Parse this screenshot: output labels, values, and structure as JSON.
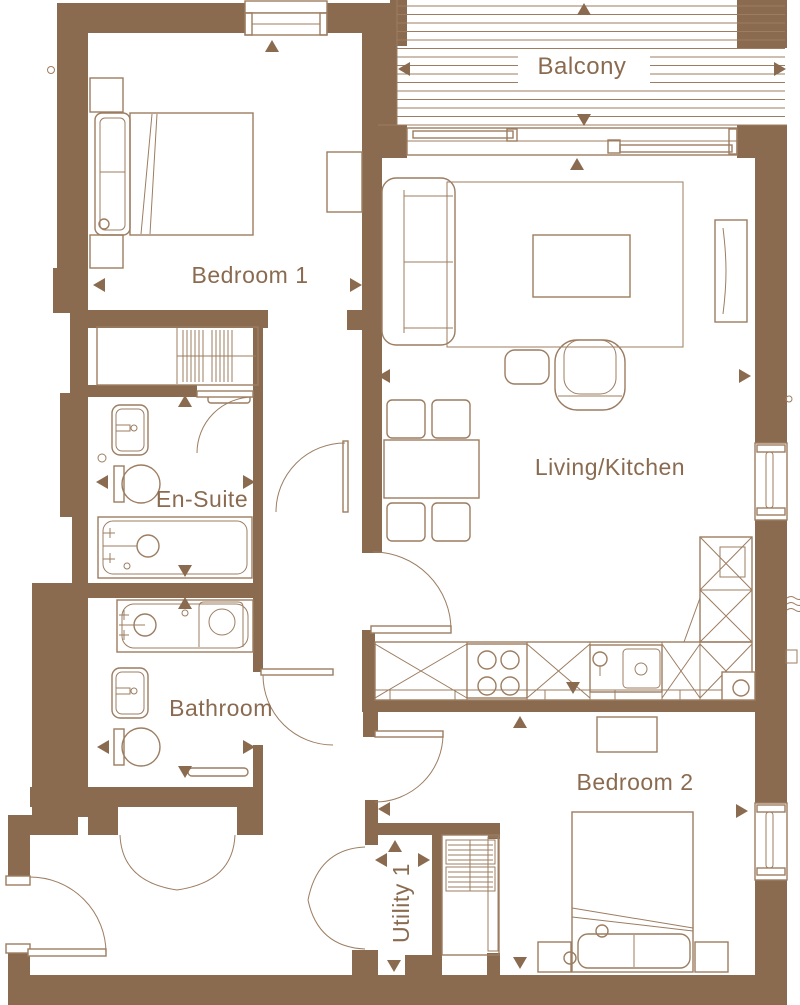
{
  "plan": {
    "type": "apartment-floor-plan",
    "colors": {
      "wall": "#8A6B50",
      "furniture": "#9C7D61",
      "text": "#8A6B50",
      "background": "#FFFFFF"
    },
    "rooms": [
      {
        "id": "balcony",
        "label": "Balcony"
      },
      {
        "id": "bedroom-1",
        "label": "Bedroom 1"
      },
      {
        "id": "living-kitchen",
        "label": "Living/Kitchen"
      },
      {
        "id": "en-suite",
        "label": "En-Suite"
      },
      {
        "id": "bathroom",
        "label": "Bathroom"
      },
      {
        "id": "bedroom-2",
        "label": "Bedroom 2"
      },
      {
        "id": "utility",
        "label": "Utility 1"
      }
    ]
  }
}
